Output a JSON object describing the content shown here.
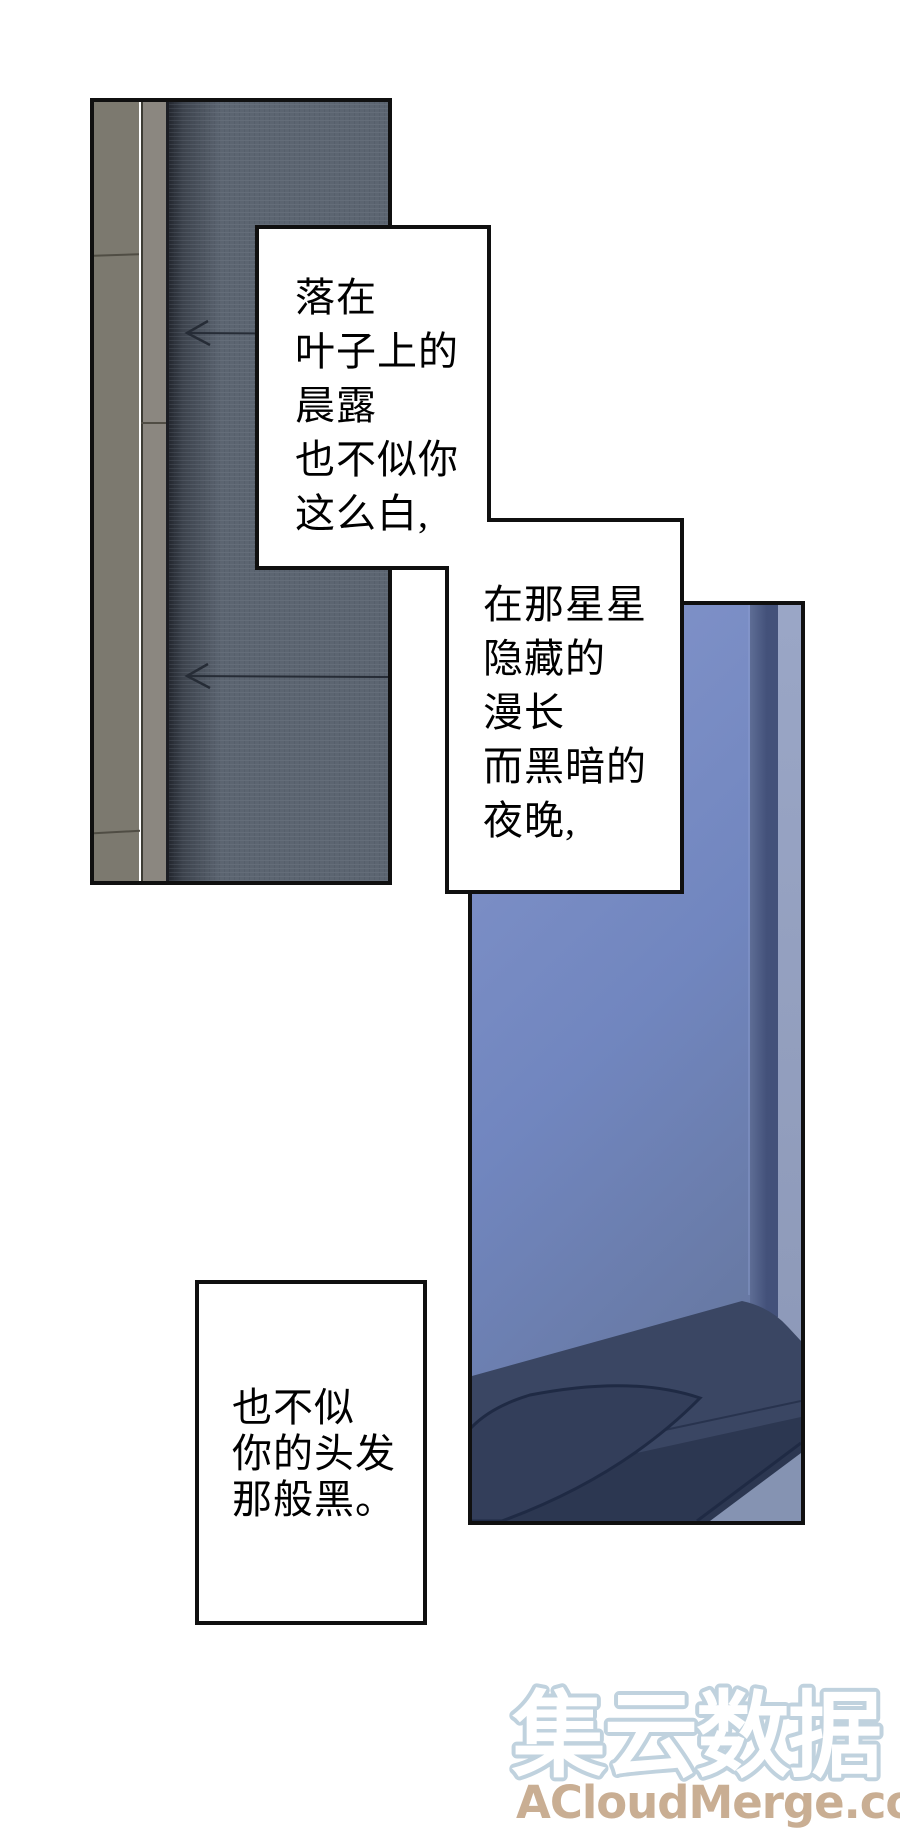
{
  "page": {
    "width": 900,
    "height": 1830,
    "background": "#ffffff",
    "border_color": "#101010"
  },
  "narration": {
    "text_color": "#000000",
    "box1": {
      "lines": [
        "落在",
        "叶子上的",
        "晨露",
        "也不似你",
        "这么白,"
      ]
    },
    "box2": {
      "lines": [
        "在那星星",
        "隐藏的",
        "漫长",
        "而黑暗的",
        "夜晚,"
      ]
    },
    "box3": {
      "lines": [
        "也不似",
        "你的头发",
        "那般黑。"
      ]
    }
  },
  "watermark": {
    "brand_text": "集云数据",
    "domain_text": "ACloudMerge.com",
    "brand_fill": "#ffffff",
    "brand_outline": "#c0d2de",
    "domain_color": "#c9ae93"
  },
  "scene": {
    "door": {
      "wood_dark": "#7c796f",
      "wood_light": "#8b8780",
      "frame_shadow": "#262b33",
      "fabric": "#5c6571",
      "seam_color": "#262c36"
    },
    "monitor": {
      "screen_top": "#8495cb",
      "screen_mid": "#7186bf",
      "screen_low": "#66779f",
      "bezel_light": "#5e6d95",
      "bezel_dark": "#43517a",
      "wall_strip_top": "#9aa6c6",
      "wall_strip_bottom": "#8b97b6",
      "desk_band": "#3a4663",
      "desk_deep": "#2c3751",
      "table": "#333e5a",
      "edge_line": "#1f2a44",
      "corner_light": "#8593b2"
    }
  }
}
